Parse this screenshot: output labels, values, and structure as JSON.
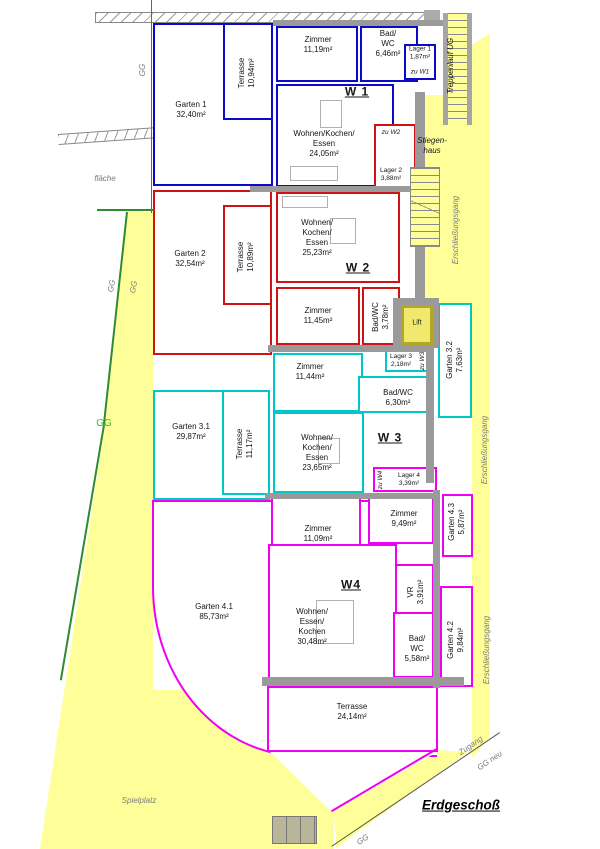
{
  "plan_title": "Erdgeschoß",
  "colors": {
    "w1": "#0a0ac8",
    "w2": "#cc1414",
    "w3": "#00c8c8",
    "w4": "#f000f0",
    "site_yellow": "#ffff99",
    "wall_gray": "#9a9a9a",
    "boundary_green": "#2e8b2e",
    "gg_green": "#3cb82c",
    "label_gray": "#7a7a7a",
    "lift_yellow": "#f0e96e",
    "lift_border": "#b3a825"
  },
  "apartments": {
    "w1": {
      "title": "W 1",
      "rooms": {
        "zimmer": "Zimmer\n11,19m²",
        "bad": "Bad/\nWC\n6,46m²",
        "wohnen": "Wohnen/Kochen/\nEssen\n24,05m²",
        "terrasse": "Terrasse\n10,94m²",
        "garten": "Garten 1\n32,40m²",
        "lager": "Lager 1\n1,87m²",
        "lager_zu": "zu W1"
      }
    },
    "w2": {
      "title": "W 2",
      "rooms": {
        "wohnen": "Wohnen/\nKochen/\nEssen\n25,23m²",
        "zimmer": "Zimmer\n11,45m²",
        "bad": "Bad/WC\n3,78m²",
        "terrasse": "Terrasse\n10,89m²",
        "garten": "Garten 2\n32,54m²",
        "lager": "Lager 2\n3,88m²",
        "lager_zu": "zu W2"
      }
    },
    "w3": {
      "title": "W 3",
      "rooms": {
        "zimmer": "Zimmer\n11,44m²",
        "bad": "Bad/WC\n6,30m²",
        "wohnen": "Wohnen/\nKochen/\nEssen\n23,65m²",
        "terrasse": "Terrasse\n11,17m²",
        "garten_1": "Garten 3.1\n29,87m²",
        "garten_2": "Garten 3.2\n7,63m²",
        "lager": "Lager 3\n2,18m²",
        "lager_zu": "zu W3"
      }
    },
    "w4": {
      "title": "W4",
      "rooms": {
        "zimmer_1": "Zimmer\n11,09m²",
        "zimmer_2": "Zimmer\n9,49m²",
        "wohnen": "Wohnen/\nEssen/\nKochen\n30,48m²",
        "bad": "Bad/\nWC\n5,58m²",
        "vr": "VR\n3,91m²",
        "terrasse": "Terrasse\n24,14m²",
        "garten_1": "Garten 4.1\n85,73m²",
        "garten_2": "Garten 4.2\n9,84m²",
        "garten_3": "Garten 4.3\n5,87m²",
        "lager": "Lager 4\n3,39m²",
        "lager_zu": "zu W4"
      }
    }
  },
  "common": {
    "stiegenhaus": "Stiegen-\nhaus",
    "treppenlauf": "Treppenlauf UG",
    "lift": "Lift",
    "erschliessungsgang": "Erschließungsgang",
    "spielplatz": "Spielplatz",
    "zugang": "Zugang"
  },
  "site": {
    "gg": "GG",
    "gg_neu": "GG neu",
    "flaeche": "fläche",
    "erdgeschoss": "Erdgeschoß"
  }
}
